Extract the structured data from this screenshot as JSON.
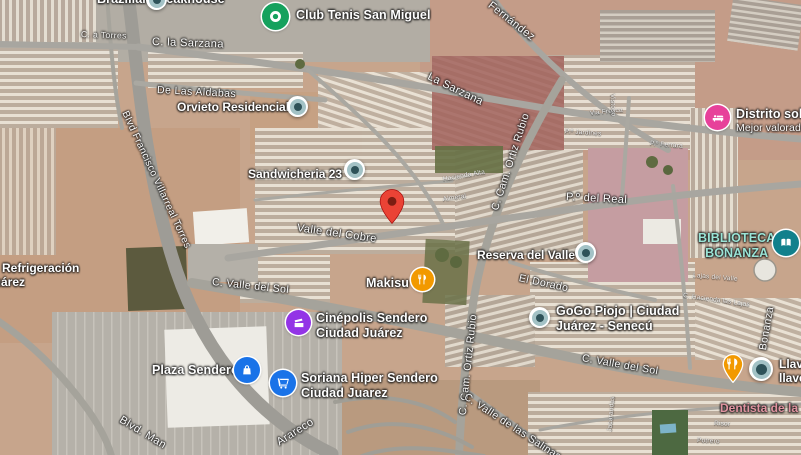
{
  "map": {
    "view": "satellite",
    "marker": {
      "type": "red-map-pin-icon",
      "color": "#EA4335"
    },
    "colors": {
      "pin_red": "#EA4335",
      "poi_green": "#15A15D",
      "poi_pink": "#E7419A",
      "poi_teal": "#11808C",
      "poi_orange": "#F29900",
      "poi_purple": "#9334E6",
      "poi_blue": "#1A73E8",
      "generic_pin_fill": "#A3C2C6",
      "library_text": "#9AE4D6",
      "dentist_text": "#E093A0"
    },
    "pois": {
      "brazilian_steakhouse": {
        "label": "Brazilian Steakhouse",
        "icon": "generic-poi-dot-icon"
      },
      "club_tenis": {
        "label": "Club Tenis San Miguel",
        "icon": "tennis-club-icon"
      },
      "orvieto": {
        "label": "Orvieto Residencial",
        "icon": "generic-poi-dot-icon"
      },
      "sandwicheria": {
        "label": "Sandwicheria 23",
        "icon": "generic-poi-dot-icon"
      },
      "distrito_soho": {
        "label": "Distrito soho",
        "sub": "Mejor valorados",
        "icon": "hotel-bed-icon"
      },
      "biblioteca": {
        "line1": "BIBLIOTECA",
        "line2": "BONANZA",
        "icon": "open-book-icon"
      },
      "reserva": {
        "label": "Reserva del Valle",
        "icon": "generic-poi-dot-icon"
      },
      "makisu": {
        "label": "Makisu",
        "icon": "restaurant-utensils-icon"
      },
      "cinepolis": {
        "line1": "Cinépolis Sendero",
        "line2": "Ciudad Juárez",
        "icon": "cinema-icon"
      },
      "plaza_sendero": {
        "label": "Plaza Sendero",
        "icon": "shopping-bag-icon"
      },
      "soriana": {
        "line1": "Soriana Hiper Sendero",
        "line2": "Ciudad Juarez",
        "icon": "shopping-cart-icon"
      },
      "gogo": {
        "line1": "GoGo Piojo | Ciudad",
        "line2": "Juárez - Senecú",
        "icon": "generic-poi-dot-icon"
      },
      "food_east": {
        "icon": "restaurant-utensils-pin-icon"
      },
      "llave": {
        "line1": "Llaves",
        "line2": "llavero",
        "icon": "generic-poi-dot-icon"
      },
      "dentista": {
        "label": "Dentista de la",
        "icon": "none"
      },
      "refrigeracion": {
        "line1": "Refrigeración",
        "line2": "Juárez",
        "icon": "none"
      }
    },
    "roads": {
      "blvd_francisco": "Blvd Francisco Villarreal Torres",
      "c_a_torres": "C. a Torres",
      "c_la_sarzana": "C. la Sarzana",
      "la_sarzana": "La Sarzana",
      "fernandez": "Fernández",
      "de_las_aldabas": "De Las Aldabas",
      "valle_del_cobre": "Valle del Cobre",
      "paseo_del_real": "P.º del Real",
      "ortiz_rubio_n": "C. Cam. Ortiz Rubio",
      "ortiz_rubio_s": "C. Cam. Ortiz Rubio",
      "el_dorado": "El Dorado",
      "valle_del_sol_w": "C. Valle del Sol",
      "valle_del_sol_e": "C. Valle del Sol",
      "bonanza": "Bonanza",
      "salinas": "C. Valle de las Salinas",
      "arareco": "Arareco",
      "blvd_man": "Blvd. Man",
      "hacienda_alta": "Hacienda Alta",
      "almeral": "Almeral",
      "via_fresca": "Via Fresca",
      "jardines": "P.º Jardines",
      "vistoso": "Vistoso",
      "ferrara": "P.º Ferrara",
      "lajas_del_valle": "Lajas del Valle",
      "hacienda_las_lajas": "C. Hacienda las Lajas",
      "jacarandas": "Jacarandas",
      "risor": "Risor",
      "potrero": "Potrero"
    }
  }
}
